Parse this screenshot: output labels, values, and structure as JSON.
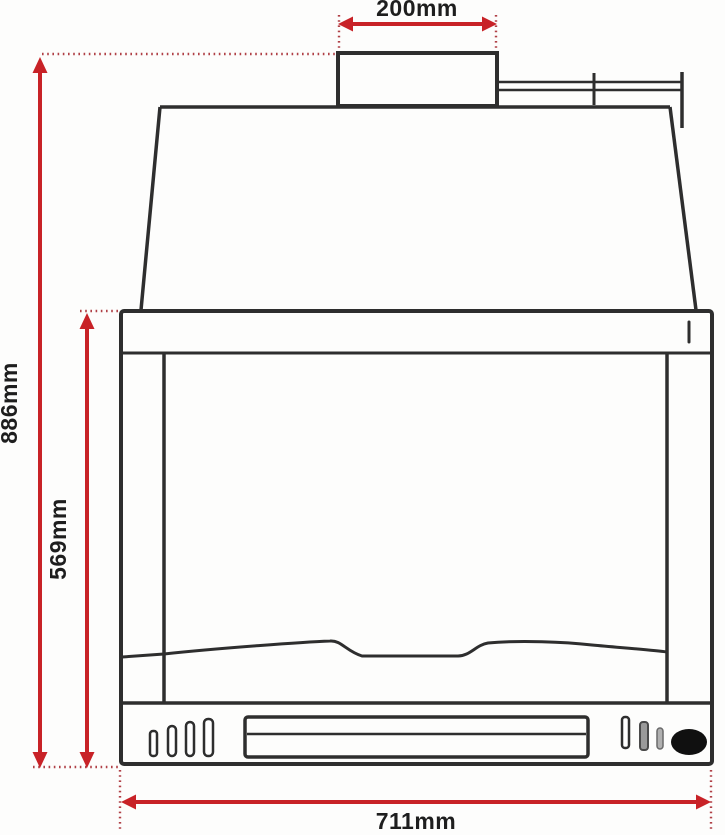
{
  "diagram": {
    "type": "technical-drawing",
    "subject": "fireplace-insert-front-elevation-with-dimensions",
    "dimensions": [
      {
        "id": "flue_outlet_width",
        "label": "200mm",
        "value": 200,
        "unit": "mm",
        "orientation": "horizontal",
        "measures": "flue-outlet-width"
      },
      {
        "id": "overall_height",
        "label": "886mm",
        "value": 886,
        "unit": "mm",
        "orientation": "vertical",
        "measures": "overall-height"
      },
      {
        "id": "firebox_height",
        "label": "569mm",
        "value": 569,
        "unit": "mm",
        "orientation": "vertical",
        "measures": "body-height"
      },
      {
        "id": "overall_width",
        "label": "711mm",
        "value": 711,
        "unit": "mm",
        "orientation": "horizontal",
        "measures": "overall-width"
      }
    ],
    "colors": {
      "dimension_red": "#c82227",
      "dot_red": "#b04046",
      "line_dark": "#2e2e2e",
      "label_black": "#1e1e1e",
      "knob_black": "#101010",
      "slot_gray": "#9a9a9a",
      "background": "#fdfdfc"
    }
  }
}
